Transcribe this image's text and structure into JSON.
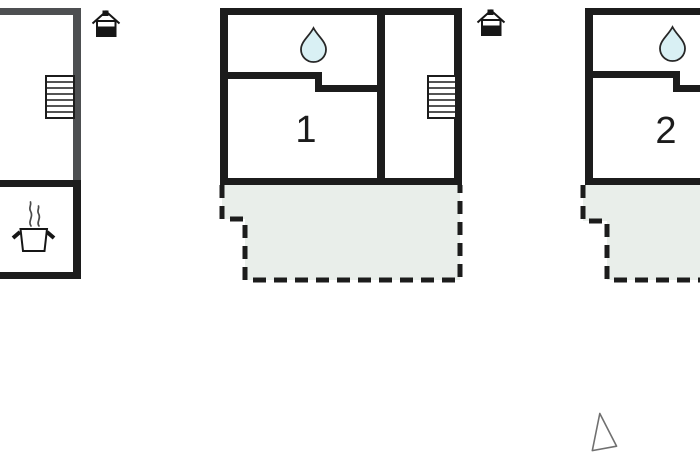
{
  "canvas": {
    "width": 700,
    "height": 459,
    "background": "#ffffff"
  },
  "colors": {
    "wall": "#1c1c1c",
    "wall_inactive": "#4d4f51",
    "terrace_fill": "#e9eeea",
    "water_drop_fill": "#d9f0f4",
    "cursor_outline": "#707070"
  },
  "plans": {
    "left": {
      "room_label": "",
      "icons": [
        "staircase",
        "cooking-pot"
      ],
      "house_marker": "house-level-icon"
    },
    "middle": {
      "room_label": "1",
      "icons": [
        "water-drop",
        "staircase",
        "terrace-dashed"
      ],
      "house_marker": "house-level-icon"
    },
    "right": {
      "room_label": "2",
      "icons": [
        "water-drop",
        "terrace-dashed"
      ]
    }
  },
  "cursor": {
    "icon": "triangle-pointer"
  }
}
